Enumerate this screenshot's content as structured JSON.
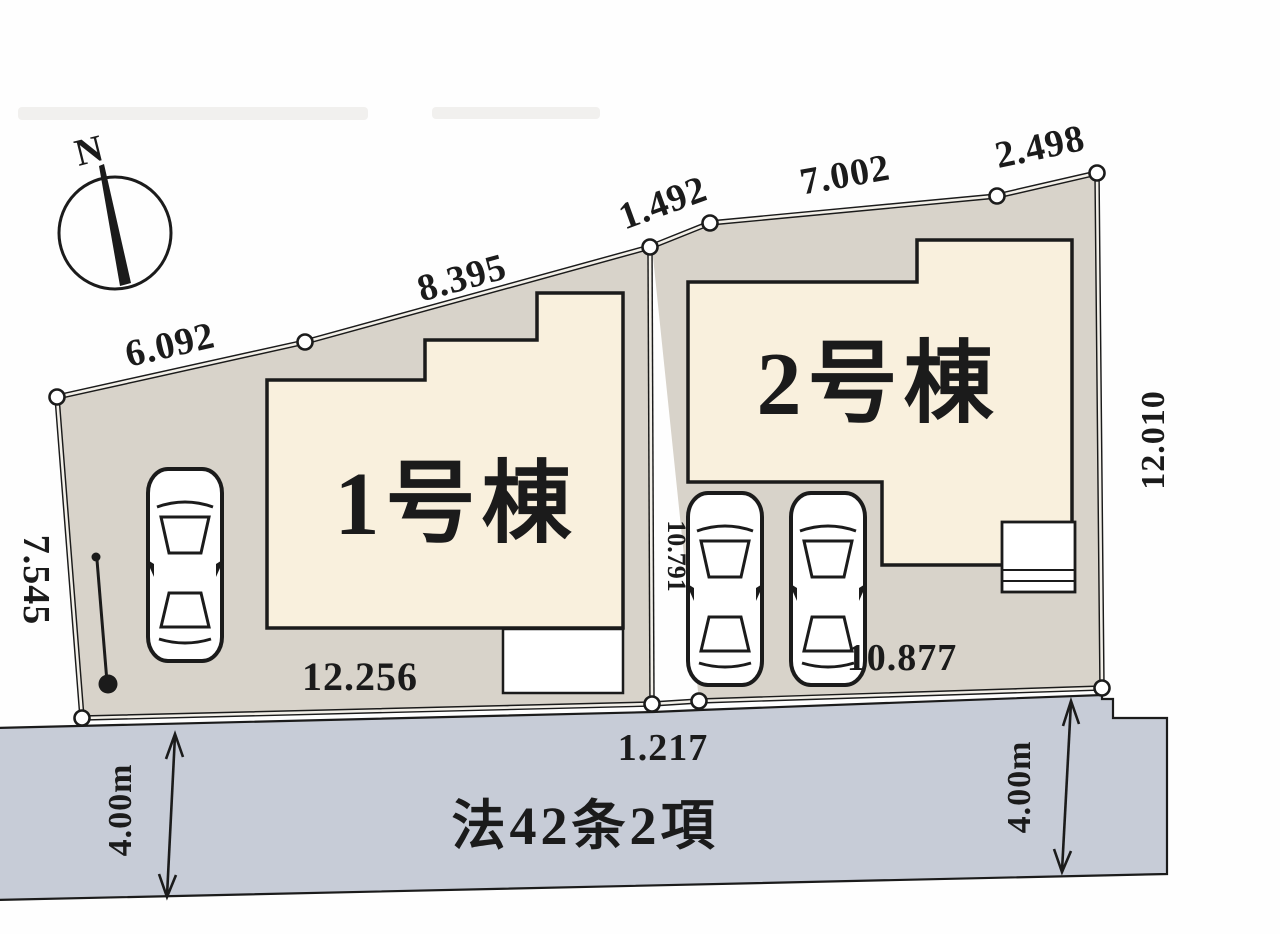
{
  "site_plan": {
    "compass": {
      "north_label": "N"
    },
    "lot1": {
      "building_label": "1号棟",
      "frontage_dim": "12.256"
    },
    "lot2": {
      "building_label": "2号棟",
      "frontage_dim": "10.877",
      "inner_dim": "10.791"
    },
    "dimensions": {
      "top_edge": [
        "6.092",
        "8.395",
        "1.492",
        "7.002",
        "2.498"
      ],
      "left_edge": "7.545",
      "right_edge": "12.010",
      "frontage_gap": "1.217"
    },
    "road": {
      "designation": "法42条2項",
      "width_left": "4.00m",
      "width_right": "4.00m"
    },
    "colors": {
      "lot_fill": "#d8d3ca",
      "building_fill": "#f9f0dd",
      "road_fill": "#c7ccd7",
      "line": "#1b1b1b",
      "background": "#fefefe"
    }
  }
}
